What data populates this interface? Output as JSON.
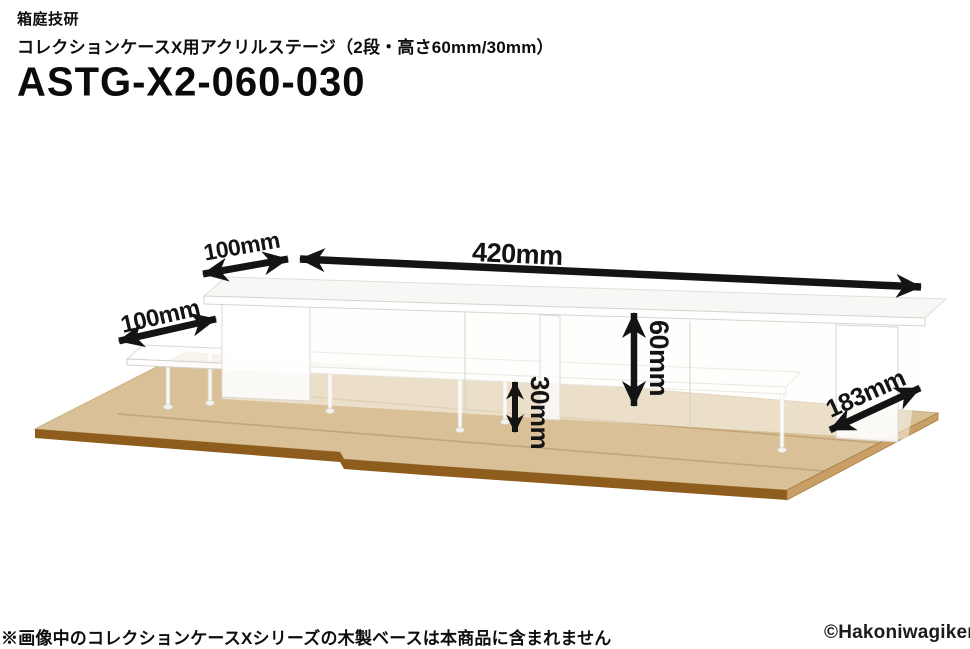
{
  "header": {
    "brand": "箱庭技研",
    "subtitle": "コレクションケースX用アクリルステージ（2段・高さ60mm/30mm）",
    "product_code": "ASTG-X2-060-030"
  },
  "dimensions": {
    "top_depth": "100mm",
    "width": "420mm",
    "lower_depth": "100mm",
    "upper_height": "60mm",
    "lower_height": "30mm",
    "base_depth": "183mm"
  },
  "footer": {
    "note": "※画像中のコレクションケースXシリーズの木製ベースは本商品に含まれません",
    "copyright": "©Hakoniwagiken"
  },
  "colors": {
    "arrow": "#141414",
    "wood_top": "#d9c096",
    "wood_front_edge": "#8e5c1d",
    "wood_right_edge": "#c89f66",
    "wood_seam": "#c3a677",
    "acrylic_stroke": "#d9d6cf",
    "acrylic_fill": "#fbfbf9"
  }
}
